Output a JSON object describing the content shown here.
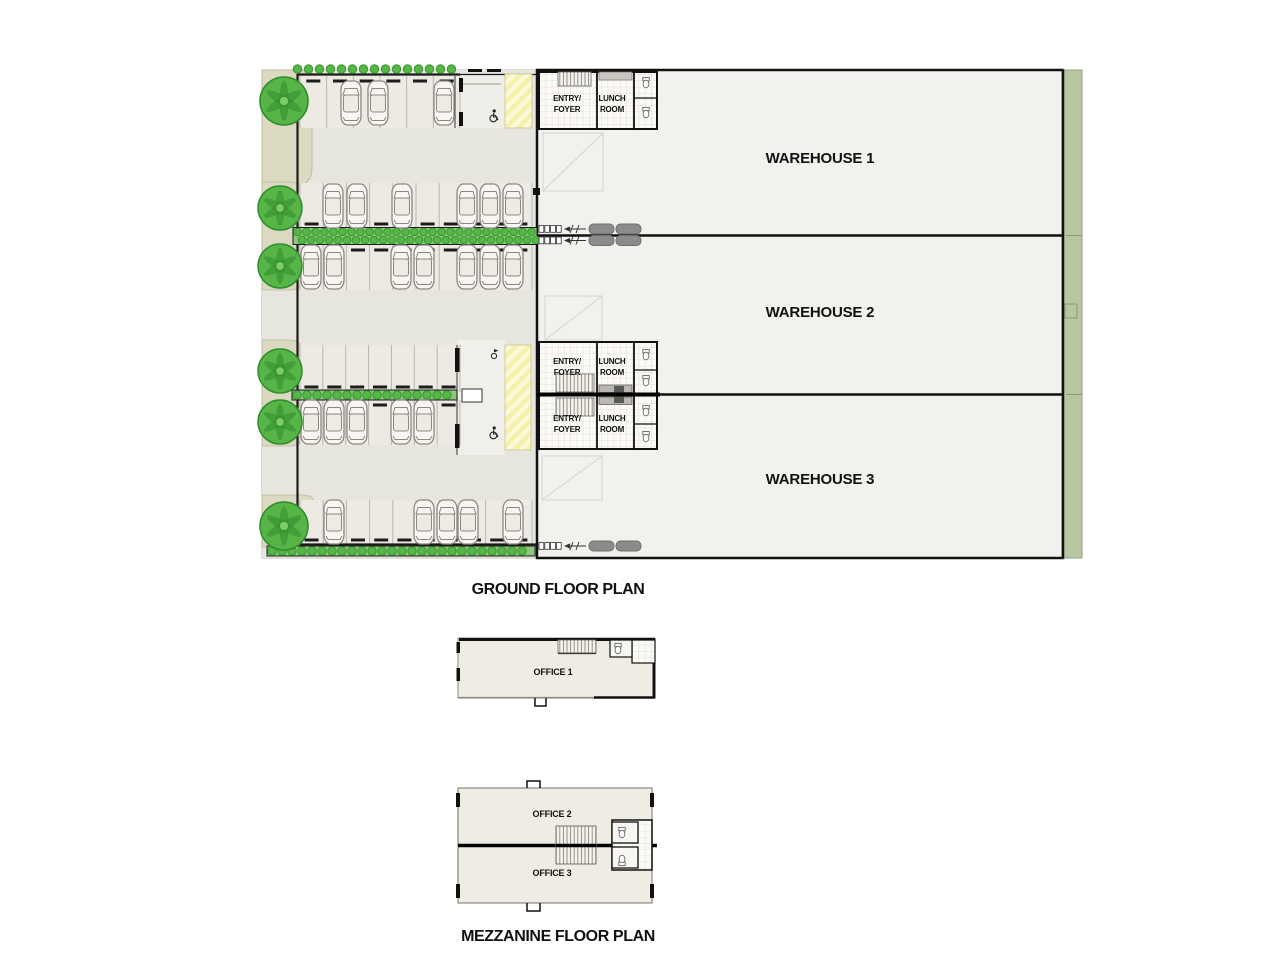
{
  "ground_floor": {
    "title": "GROUND FLOOR PLAN",
    "warehouses": [
      {
        "label": "WAREHOUSE 1"
      },
      {
        "label": "WAREHOUSE 2"
      },
      {
        "label": "WAREHOUSE 3"
      }
    ],
    "rooms": {
      "entry_line1": "ENTRY/",
      "entry_line2": "FOYER",
      "lunch_line1": "LUNCH",
      "lunch_line2": "ROOM"
    }
  },
  "mezzanine": {
    "title": "MEZZANINE FLOOR PLAN",
    "offices": [
      {
        "label": "OFFICE 1"
      },
      {
        "label": "OFFICE 2"
      },
      {
        "label": "OFFICE 3"
      }
    ]
  },
  "palette": {
    "paving": "#e6e5de",
    "stall_fill": "#eceae3",
    "stall_line": "#b9b7ae",
    "warehouse_floor": "#f1f1ee",
    "office_floor": "#efede3",
    "verge_green": "#b9c7a0",
    "tree_green": "#57b447",
    "tree_dark": "#2f8c2c",
    "bush_green": "#55b748",
    "bush_edge": "#37962e",
    "hedge_band": "#8fc57e",
    "tan_patch": "#dbd9c1",
    "walkway_yellow": "#f5f1ab",
    "truck_grey": "#8b8b8b",
    "wall": "#111111"
  },
  "symbols": {
    "cars": [
      [
        351,
        103
      ],
      [
        378,
        103
      ],
      [
        444,
        103
      ],
      [
        333,
        206
      ],
      [
        357,
        206
      ],
      [
        402,
        206
      ],
      [
        467,
        206
      ],
      [
        490,
        206
      ],
      [
        513,
        206
      ],
      [
        311,
        267
      ],
      [
        334,
        267
      ],
      [
        401,
        267
      ],
      [
        424,
        267
      ],
      [
        467,
        267
      ],
      [
        490,
        267
      ],
      [
        513,
        267
      ],
      [
        311,
        422
      ],
      [
        334,
        422
      ],
      [
        357,
        422
      ],
      [
        401,
        422
      ],
      [
        424,
        422
      ],
      [
        334,
        522
      ],
      [
        424,
        522
      ],
      [
        447,
        522
      ],
      [
        468,
        522
      ],
      [
        513,
        522
      ]
    ],
    "trees": [
      [
        284,
        101,
        24
      ],
      [
        280,
        208,
        22
      ],
      [
        280,
        266,
        22
      ],
      [
        280,
        371,
        22
      ],
      [
        280,
        422,
        22
      ],
      [
        284,
        526,
        24
      ]
    ],
    "hedgerows": [
      {
        "x": 292,
        "y": 69,
        "w": 166,
        "spacing": 11,
        "band": false,
        "double": false
      },
      {
        "x": 293,
        "y": 236,
        "w": 244,
        "spacing": 9,
        "band": true,
        "double": true
      },
      {
        "x": 292,
        "y": 395,
        "w": 165,
        "spacing": 10,
        "band": true,
        "double": false
      },
      {
        "x": 267,
        "y": 551,
        "w": 268,
        "spacing": 10,
        "band": true,
        "double": false
      }
    ],
    "parking_rows": [
      {
        "x": 300,
        "y": 76,
        "w": 160,
        "h": 52,
        "stalls": 6,
        "dashY": 81
      },
      {
        "x": 300,
        "y": 183,
        "w": 232,
        "h": 45,
        "stalls": 10,
        "dashY": 224
      },
      {
        "x": 300,
        "y": 245,
        "w": 232,
        "h": 45,
        "stalls": 10,
        "dashY": 250
      },
      {
        "x": 300,
        "y": 345,
        "w": 160,
        "h": 47,
        "stalls": 7,
        "dashY": 387
      },
      {
        "x": 300,
        "y": 400,
        "w": 160,
        "h": 45,
        "stalls": 7,
        "dashY": 405
      },
      {
        "x": 300,
        "y": 500,
        "w": 232,
        "h": 45,
        "stalls": 10,
        "dashY": 540
      }
    ],
    "docks": [
      {
        "x": 539,
        "y": 229,
        "rows": 2
      },
      {
        "x": 539,
        "y": 546,
        "rows": 1
      }
    ]
  }
}
